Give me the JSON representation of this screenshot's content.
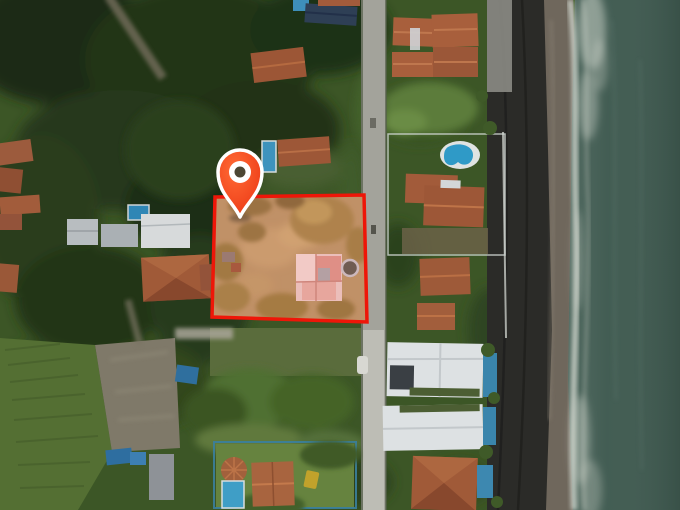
{
  "scene": {
    "type": "aerial-drone-photograph",
    "description": "Top-down drone photo of a beachfront neighborhood: tropical vegetation and houses on the left, a vertical street in the middle, beachfront villas with pools, a dark volcanic-sand beach and teal ocean on the right. A for-sale lot is highlighted with a red boundary, a translucent red tint and a red map pin.",
    "text_visible": "none"
  },
  "overlay": {
    "location_pin": {
      "name": "location-pin",
      "color_start": "#ff6a35",
      "color_end": "#e93110",
      "outline": "#ffffff",
      "hole": "#4d4734",
      "tip_x": 240,
      "tip_y": 217
    },
    "property_boundary": {
      "stroke": "#ee1608",
      "stroke_width": 3.5,
      "points": "215,197 364,195 367,322 212,317",
      "tint": "#f25a55",
      "tint_opacity": 0.16
    }
  },
  "palette": {
    "water": "#3f5a50",
    "foam": "#ccd2c9",
    "dry_sand": "#2b2b28",
    "wet_sand": "#6f675c",
    "road": "#a3a39b",
    "beach_road": "#8b8b84",
    "vegetation_dark": "#223517",
    "vegetation_mid": "#3c5626",
    "grass_light": "#5d7a38",
    "roof_terracotta": "#9d5737",
    "roof_white": "#dde1e3",
    "roof_navy": "#2e3f55",
    "pool_blue": "#2f86b5",
    "lot_ground": "#b79c6a",
    "lot_tree": "#a28b4c"
  }
}
